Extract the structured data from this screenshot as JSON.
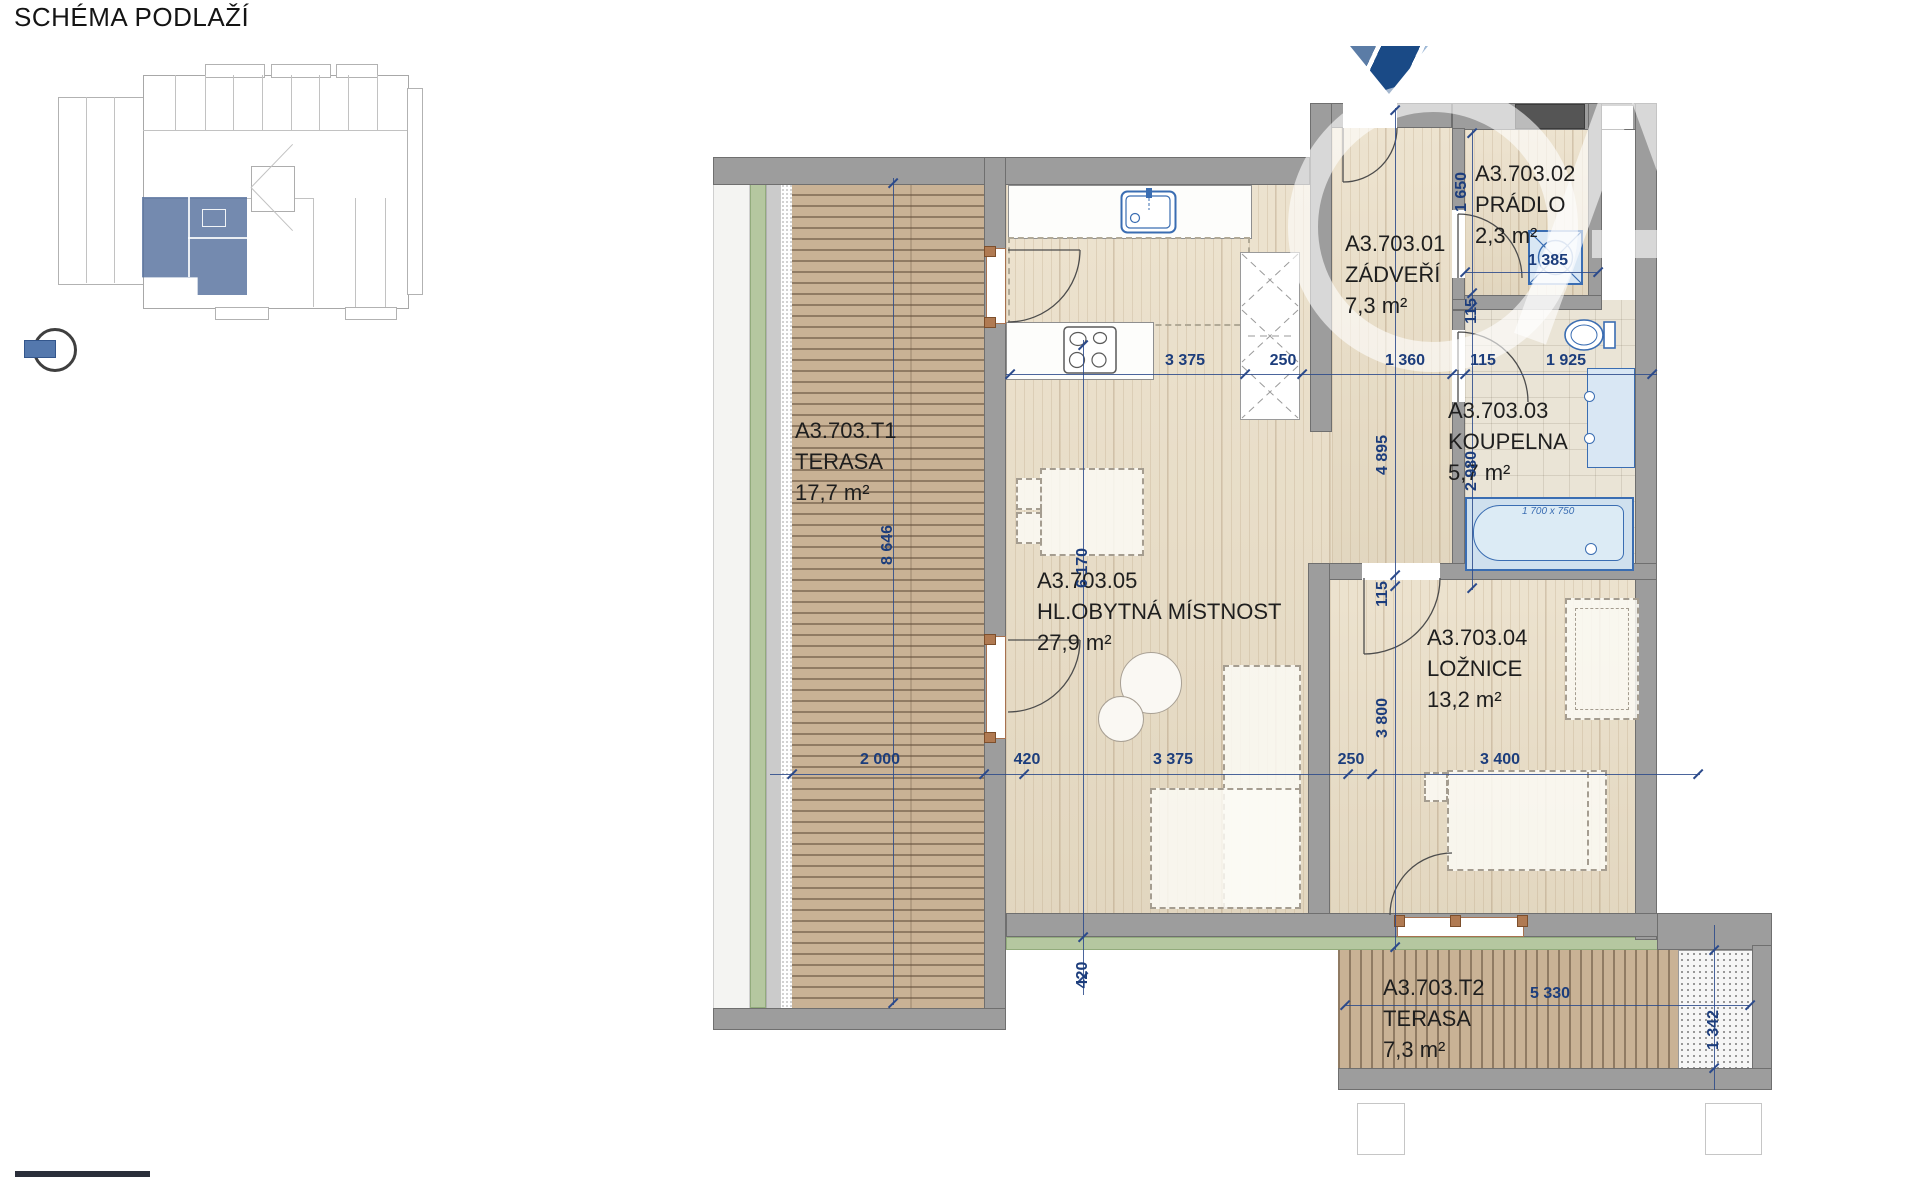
{
  "title": "SCHÉMA PODLAŽÍ",
  "unit_code": "A3.703",
  "colors": {
    "dimension_blue": "#1c3d7c",
    "fixture_blue": "#3a6db2",
    "wall_gray": "#9d9d9d",
    "floor_wood": "#e9ddc5",
    "deck_wood": "#c9b295",
    "terrace_green": "#b5c7a0",
    "unit_highlight": "#56709e",
    "logo_navy": "#1a4a86"
  },
  "rooms": [
    {
      "id": "A3.703.T1",
      "name": "TERASA",
      "area": "17,7 m²",
      "x": 795,
      "y": 415
    },
    {
      "id": "A3.703.05",
      "name": "HL.OBYTNÁ MÍSTNOST",
      "area": "27,9 m²",
      "x": 1037,
      "y": 565
    },
    {
      "id": "A3.703.01",
      "name": "ZÁDVEŘÍ",
      "area": "7,3 m²",
      "x": 1345,
      "y": 228
    },
    {
      "id": "A3.703.02",
      "name": "PRÁDLO",
      "area": "2,3 m²",
      "x": 1475,
      "y": 158
    },
    {
      "id": "A3.703.03",
      "name": "KOUPELNA",
      "area": "5,7 m²",
      "x": 1448,
      "y": 395
    },
    {
      "id": "A3.703.04",
      "name": "LOŽNICE",
      "area": "13,2 m²",
      "x": 1427,
      "y": 622
    },
    {
      "id": "A3.703.T2",
      "name": "TERASA",
      "area": "7,3 m²",
      "x": 1383,
      "y": 972
    }
  ],
  "dimensions": {
    "horizontal": [
      {
        "t": "3 375",
        "x": 1185,
        "y": 361
      },
      {
        "t": "250",
        "x": 1283,
        "y": 361
      },
      {
        "t": "1 360",
        "x": 1405,
        "y": 361
      },
      {
        "t": "115",
        "x": 1483,
        "y": 361
      },
      {
        "t": "1 925",
        "x": 1566,
        "y": 361
      },
      {
        "t": "1 385",
        "x": 1548,
        "y": 261
      },
      {
        "t": "2 000",
        "x": 880,
        "y": 760
      },
      {
        "t": "420",
        "x": 1027,
        "y": 760
      },
      {
        "t": "3 375",
        "x": 1173,
        "y": 760
      },
      {
        "t": "250",
        "x": 1351,
        "y": 760
      },
      {
        "t": "3 400",
        "x": 1500,
        "y": 760
      },
      {
        "t": "5 330",
        "x": 1550,
        "y": 994
      }
    ],
    "vertical": [
      {
        "t": "8 646",
        "x": 888,
        "y": 545
      },
      {
        "t": "6 170",
        "x": 1083,
        "y": 568
      },
      {
        "t": "420",
        "x": 1083,
        "y": 975
      },
      {
        "t": "4 895",
        "x": 1383,
        "y": 455
      },
      {
        "t": "115",
        "x": 1383,
        "y": 594
      },
      {
        "t": "3 800",
        "x": 1383,
        "y": 718
      },
      {
        "t": "1 650",
        "x": 1462,
        "y": 192
      },
      {
        "t": "115",
        "x": 1472,
        "y": 311
      },
      {
        "t": "2 980",
        "x": 1472,
        "y": 471
      },
      {
        "t": "1 342",
        "x": 1714,
        "y": 1030
      }
    ],
    "bathtub": "1 700 x 750"
  },
  "dim_lines": {
    "h": [
      {
        "y": 374,
        "x1": 1006,
        "x2": 1657,
        "ticks": [
          1010,
          1245,
          1302,
          1452,
          1465,
          1652
        ]
      },
      {
        "y": 272,
        "x1": 1465,
        "x2": 1598,
        "ticks": [
          1465,
          1598
        ]
      },
      {
        "y": 774,
        "x1": 770,
        "x2": 1700,
        "ticks": [
          792,
          984,
          1024,
          1348,
          1372,
          1698
        ]
      },
      {
        "y": 1005,
        "x1": 1345,
        "x2": 1750,
        "ticks": [
          1345,
          1750
        ]
      }
    ],
    "v": [
      {
        "x": 893,
        "y1": 178,
        "y2": 1005,
        "ticks": [
          183,
          1003
        ]
      },
      {
        "x": 1083,
        "y1": 340,
        "y2": 995,
        "ticks": [
          345,
          937,
          977
        ]
      },
      {
        "x": 1395,
        "y1": 108,
        "y2": 950,
        "ticks": [
          110,
          575,
          586,
          947
        ]
      },
      {
        "x": 1472,
        "y1": 130,
        "y2": 590,
        "ticks": [
          133,
          293,
          307,
          588
        ]
      },
      {
        "x": 1714,
        "y1": 925,
        "y2": 1090,
        "ticks": [
          950,
          1068
        ]
      }
    ]
  }
}
